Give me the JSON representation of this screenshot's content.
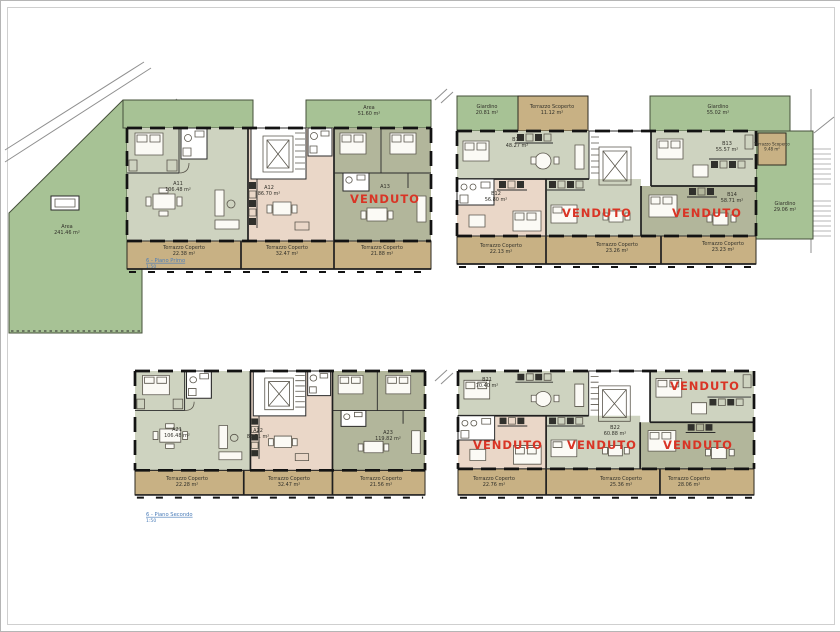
{
  "labels": {
    "venduto": "VENDUTO"
  },
  "colors": {
    "garden": "#a7c295",
    "terrace": "#c8b184",
    "sage": "#ced3c0",
    "pink": "#ead7c8",
    "olive": "#b2b69b",
    "red": "#d93425",
    "blue": "#4a7cb8"
  },
  "floor1": {
    "caption": {
      "title": "6 - Piano Primo",
      "scale": "1:50"
    },
    "building_a": {
      "garden": {
        "name": "Area",
        "value": "241.46 m²"
      },
      "strip": {
        "name": "Area",
        "value": "51.60 m²"
      },
      "units": [
        {
          "id": "A11",
          "area": "106.48 m²"
        },
        {
          "id": "A12",
          "area": "86.70 m²"
        },
        {
          "id": "A13"
        }
      ],
      "terraces": [
        {
          "name": "Terrazzo Coperto",
          "value": "22.38 m²"
        },
        {
          "name": "Terrazzo Coperto",
          "value": "32.47 m²"
        },
        {
          "name": "Terrazzo Coperto",
          "value": "21.88 m²"
        }
      ]
    },
    "building_b": {
      "garden_left": {
        "name": "Giardino",
        "value": "20.81 m²"
      },
      "scoperto_left": {
        "name": "Terrazzo Scoperto",
        "value": "11.12 m²"
      },
      "garden_top": {
        "name": "Giardino",
        "value": "55.02 m²"
      },
      "scoperto_right": {
        "name": "Terrazzo Scoperto",
        "value": "9.48 m²"
      },
      "garden_right": {
        "name": "Giardino",
        "value": "29.06 m²"
      },
      "units": [
        {
          "id": "B11",
          "area": "48.27 m²"
        },
        {
          "id": "B12",
          "area": "56.80 m²"
        },
        {
          "id": "B13",
          "area": "55.57 m²"
        },
        {
          "id": "B14",
          "area": "58.71 m²"
        }
      ],
      "terraces": [
        {
          "name": "Terrazzo Coperto",
          "value": "22.13 m²"
        },
        {
          "name": "Terrazzo Coperto",
          "value": "23.26 m²"
        },
        {
          "name": "Terrazzo Coperto",
          "value": "23.23 m²"
        }
      ]
    }
  },
  "floor2": {
    "caption": {
      "title": "6 - Piano Secondo",
      "scale": "1:50"
    },
    "building_a": {
      "units": [
        {
          "id": "A21",
          "area": "106.48 m²"
        },
        {
          "id": "A22",
          "area": "88.51 m²"
        },
        {
          "id": "A23",
          "area": "119.82 m²"
        }
      ],
      "terraces": [
        {
          "name": "Terrazzo Coperto",
          "value": "22.28 m²"
        },
        {
          "name": "Terrazzo Coperto",
          "value": "32.47 m²"
        },
        {
          "name": "Terrazzo Coperto",
          "value": "21.56 m²"
        }
      ]
    },
    "building_b": {
      "units": [
        {
          "id": "B21",
          "area": "70.40 m²"
        },
        {
          "id": "B22",
          "area": "60.88 m²"
        }
      ],
      "terraces": [
        {
          "name": "Terrazzo Coperto",
          "value": "22.76 m²"
        },
        {
          "name": "Terrazzo Coperto",
          "value": "25.36 m²"
        },
        {
          "name": "Terrazzo Coperto",
          "value": "28.06 m²"
        }
      ]
    }
  }
}
